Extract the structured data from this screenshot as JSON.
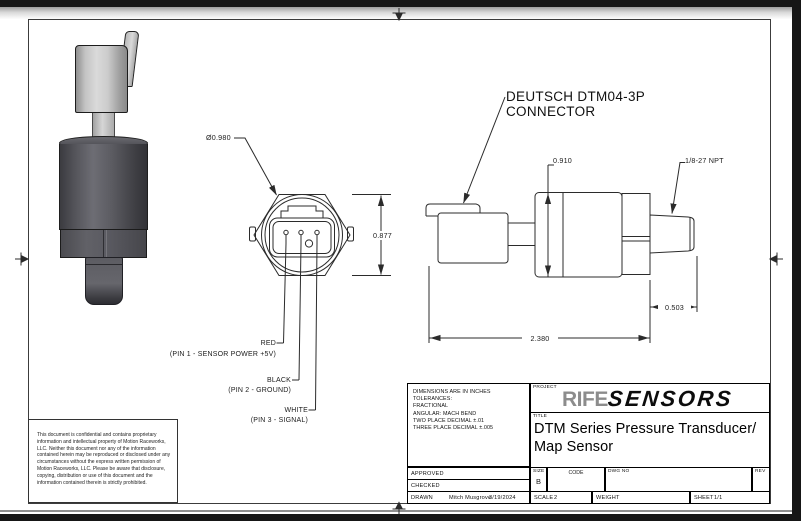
{
  "drawing": {
    "front_view": {
      "diameter": "Ø0.980",
      "height": "0.877",
      "pins": [
        {
          "wire": "RED",
          "desc": "(PIN 1 - SENSOR POWER +5V)"
        },
        {
          "wire": "BLACK",
          "desc": "(PIN 2 - GROUND)"
        },
        {
          "wire": "WHITE",
          "desc": "(PIN 3 - SIGNAL)"
        }
      ]
    },
    "side_view": {
      "connector_callout_line1": "DEUTSCH DTM04-3P",
      "connector_callout_line2": "CONNECTOR",
      "body_height": "0.910",
      "thread_spec": "1/8-27 NPT",
      "thread_length": "0.503",
      "overall_length": "2.380"
    }
  },
  "title_block": {
    "notes": [
      "DIMENSIONS ARE IN INCHES",
      "TOLERANCES:",
      "FRACTIONAL",
      "ANGULAR: MACH BEND",
      "TWO PLACE DECIMAL ±.01",
      "THREE PLACE DECIMAL ±.005"
    ],
    "project_label": "PROJECT",
    "logo_rife": "RIFE",
    "logo_sensors": "SENSORS",
    "title_label": "TITLE",
    "title_line1": "DTM Series Pressure Transducer/",
    "title_line2": "Map Sensor",
    "approved_label": "APPROVED",
    "checked_label": "CHECKED",
    "drawn_label": "DRAWN",
    "drawn_by": "Mitch Musgrove",
    "drawn_date": "3/19/2024",
    "size_label": "SIZE",
    "size_value": "B",
    "code_label": "CODE",
    "dwg_no_label": "DWG NO",
    "rev_label": "REV",
    "scale_label": "SCALE",
    "scale_value": "2",
    "weight_label": "WEIGHT",
    "sheet_label": "SHEET",
    "sheet_value": "1/1"
  },
  "disclaimer": "This document is confidential and contains proprietary information and intellectual property of Motion Raceworks, LLC. Neither this document nor any of the information contained herein may be reproduced or disclosed under any circumstances without the express written permission of Motion Raceworks, LLC. Please be aware that disclosure, copying, distribution or use of this document and the information contained therein is strictly prohibited.",
  "colors": {
    "line": "#2b2b2b",
    "logo_gray": "#8c8c8c",
    "frame": "#161616"
  }
}
